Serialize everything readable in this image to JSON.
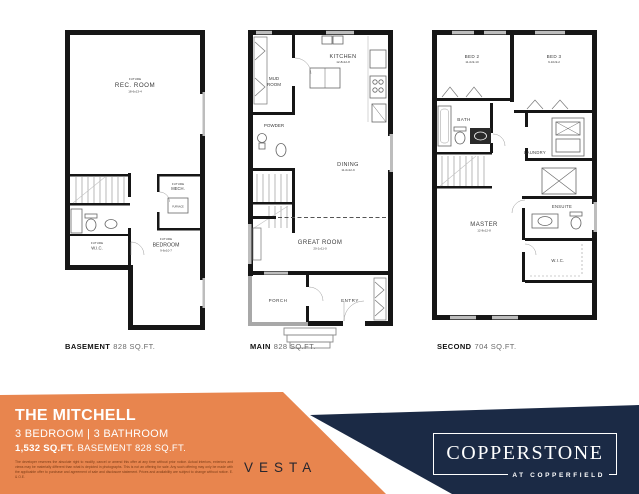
{
  "colors": {
    "orange": "#E8854E",
    "navy": "#1B2A45",
    "wall": "#161616",
    "window_gray": "#bdbdbd"
  },
  "plans": {
    "basement": {
      "caption_name": "BASEMENT",
      "caption_sqft": "828 SQ.FT.",
      "rec_room": {
        "future": "FUTURE",
        "name": "REC. ROOM",
        "dims": "18-6x13-4"
      },
      "mech": {
        "future": "FUTURE",
        "name": "MECH."
      },
      "furnace": "FURNACE",
      "wic": {
        "future": "FUTURE",
        "name": "W.I.C."
      },
      "bedroom": {
        "future": "FUTURE",
        "name": "BEDROOM",
        "dims": "9-6x10-7"
      }
    },
    "main": {
      "caption_name": "MAIN",
      "caption_sqft": "828 SQ.FT.",
      "mud_room_1": "MUD",
      "mud_room_2": "ROOM",
      "kitchen": {
        "name": "KITCHEN",
        "dims": "12-8x12-8"
      },
      "powder": "POWDER",
      "dining": {
        "name": "DINING",
        "dims": "11-0x12-9"
      },
      "great_room": {
        "name": "GREAT ROOM",
        "dims": "20-1x11-0"
      },
      "porch": "PORCH",
      "entry": "ENTRY"
    },
    "second": {
      "caption_name": "SECOND",
      "caption_sqft": "704 SQ.FT.",
      "bed2": {
        "name": "BED 2",
        "dims": "11-0x9-10"
      },
      "bed3": {
        "name": "BED 3",
        "dims": "9-10x9-2"
      },
      "bath": "BATH",
      "laundry": "LAUNDRY",
      "master": {
        "name": "MASTER",
        "dims": "12-8x12-8"
      },
      "ensuite": "ENSUITE",
      "wic": "W.I.C."
    }
  },
  "banner": {
    "title": "THE MITCHELL",
    "subtitle": "3 BEDROOM | 3 BATHROOM",
    "area_bold": "1,532 SQ.FT.",
    "area_rest": "BASEMENT 828 SQ.FT.",
    "disclaimer": "The developer reserves the absolute right to modify, cancel or amend this offer at any time without prior notice. Actual interiors, exteriors and views may be materially different than what is depicted in photographs. This is not an offering for sale. Any such offering may only be made with the applicable offer to purchase and agreement of sale and disclosure statement. Prices and availability are subject to change without notice. E. & O.E."
  },
  "brand": {
    "vesta": "VESTA",
    "copperstone": "COPPERSTONE",
    "tagline": "AT COPPERFIELD"
  }
}
